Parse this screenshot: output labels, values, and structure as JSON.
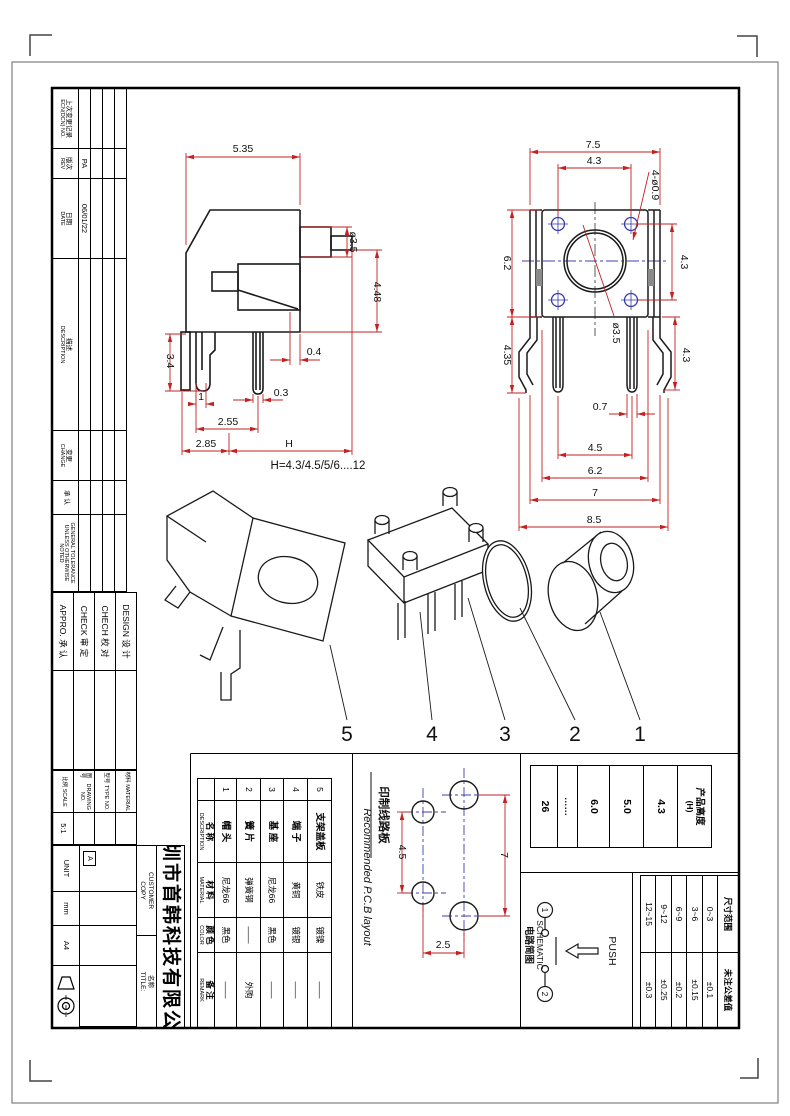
{
  "sheet": {
    "revision_table": {
      "columns": [
        {
          "zh": "上次变更记录",
          "en": "ECN(DCN) NO."
        },
        {
          "zh": "版次",
          "en": "REV"
        },
        {
          "zh": "日期",
          "en": "DATE"
        },
        {
          "zh": "描述",
          "en": "DESCRIPTION"
        },
        {
          "zh": "变更",
          "en": "CHANGE"
        },
        {
          "zh": "承 认",
          "en": ""
        },
        {
          "zh": "",
          "en": "GENERAL TOLERANCE UNLESS OTHERWISE NOTED"
        }
      ],
      "entry": {
        "rev": "PA",
        "date": "06/01/22"
      }
    },
    "signoff": {
      "rows": [
        {
          "en": "DESIGN",
          "zh": "设 计"
        },
        {
          "en": "CHECH",
          "zh": "校 对"
        },
        {
          "en": "CHECK",
          "zh": "审 定"
        },
        {
          "en": "APPRO.",
          "zh": "承 认"
        }
      ]
    },
    "info": {
      "rows": [
        {
          "zh": "材料",
          "en": "MATERIAL",
          "value": ""
        },
        {
          "zh": "型号",
          "en": "TYPE NO.",
          "value": ""
        },
        {
          "zh": "图号",
          "en": "DRAWING NO.",
          "value": ""
        },
        {
          "zh": "比例",
          "en": "SCALE",
          "value": "5:1"
        }
      ]
    },
    "title_block": {
      "company": "深圳市首韩科技有限公司",
      "customer_line1": "CUSTOMER",
      "customer_line2": "COPY",
      "title_zh": "名称",
      "title_en": "TITLE:",
      "unit_label": "UNIT",
      "unit_value": "mm",
      "paper": "A4",
      "rev_mark": "A"
    },
    "parts_table": {
      "header": {
        "name_zh": "名 称",
        "name_en": "DESCRIPTION",
        "mat_zh": "材 料",
        "mat_en": "MATERIAL",
        "color_zh": "颜 色",
        "color_en": "COLOR",
        "remark_zh": "备 注",
        "remark_en": "REMARK"
      },
      "rows": [
        {
          "no": "5",
          "name": "支架盖板",
          "material": "铁皮",
          "color": "镀镍",
          "remark": "——"
        },
        {
          "no": "4",
          "name": "端 子",
          "material": "黄铜",
          "color": "镀银",
          "remark": "——"
        },
        {
          "no": "3",
          "name": "基 座",
          "material": "尼龙66",
          "color": "黑色",
          "remark": "——"
        },
        {
          "no": "2",
          "name": "簧 片",
          "material": "弹簧钢",
          "color": "——",
          "remark": "外购"
        },
        {
          "no": "1",
          "name": "帽 头",
          "material": "尼龙66",
          "color": "黑色",
          "remark": "——"
        }
      ]
    },
    "height_table": {
      "header_zh": "产品高度",
      "header_sub": "(H)",
      "values": [
        "4.3",
        "5.0",
        "6.0",
        "……",
        "26"
      ]
    },
    "tolerance_table": {
      "header_range": "尺寸范围",
      "header_tol": "未注公差值",
      "rows": [
        {
          "range": "0~3",
          "tol": "±0.1"
        },
        {
          "range": "3~6",
          "tol": "±0.15"
        },
        {
          "range": "6~9",
          "tol": "±0.2"
        },
        {
          "range": "9~12",
          "tol": "±0.25"
        },
        {
          "range": "12~15",
          "tol": "±0.3"
        }
      ]
    },
    "pcb": {
      "label_zh": "印制线路板",
      "label_en": "Recommended P.C.B layout",
      "dim_45": "4.5",
      "dim_7": "7",
      "dim_25": "2.5"
    },
    "schematic": {
      "label_zh": "电路简图",
      "label_en": "SCHEMATIC",
      "push": "PUSH",
      "t1": "1",
      "t2": "2"
    },
    "side_view": {
      "d535": "5.35",
      "d35": "ø3.5",
      "d448": "4.48",
      "d04": "0.4",
      "d34": "3.4",
      "d03": "0.3",
      "d1": "1",
      "d255": "2.55",
      "d285": "2.85",
      "dH": "H",
      "note": "H=4.3/4.5/5/6....12"
    },
    "front_view": {
      "d75": "7.5",
      "d43top": "4.3",
      "d409": "4-ø0.9",
      "d62left": "6.2",
      "d43r1": "4.3",
      "d435": "4.35",
      "d35": "ø3.5",
      "d43r2": "4.3",
      "d07": "0.7",
      "d45": "4.5",
      "d62bot": "6.2",
      "d7": "7",
      "d85": "8.5"
    },
    "exploded": {
      "labels": [
        "5",
        "4",
        "3",
        "2",
        "1"
      ]
    }
  }
}
